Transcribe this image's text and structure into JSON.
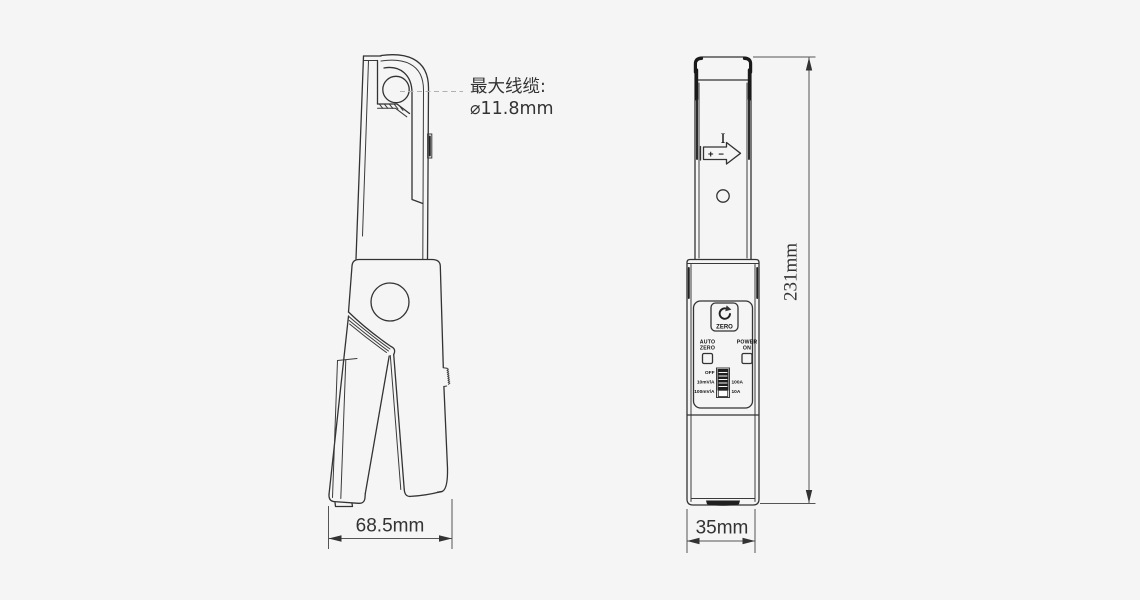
{
  "colors": {
    "background": "#f5f5f5",
    "line": "#333333",
    "dark": "#1a1a1a",
    "leader_line": "#b0b0b0"
  },
  "side_view": {
    "annotation_line1": "最大线缆:",
    "annotation_line2": "⌀11.8mm",
    "width_dimension": "68.5mm"
  },
  "front_view": {
    "current_marking": "I",
    "plus": "+",
    "minus": "−",
    "zero_button_label": "ZERO",
    "auto_label_line1": "AUTO",
    "auto_label_line2": "ZERO",
    "power_label_line1": "POWER",
    "power_label_line2": "ON",
    "switch_off": "OFF",
    "switch_10mva": "10mV/A",
    "switch_100mva": "100mV/A",
    "switch_100a": "100A",
    "switch_10a": "10A",
    "width_dimension": "35mm",
    "height_dimension": "231mm"
  }
}
